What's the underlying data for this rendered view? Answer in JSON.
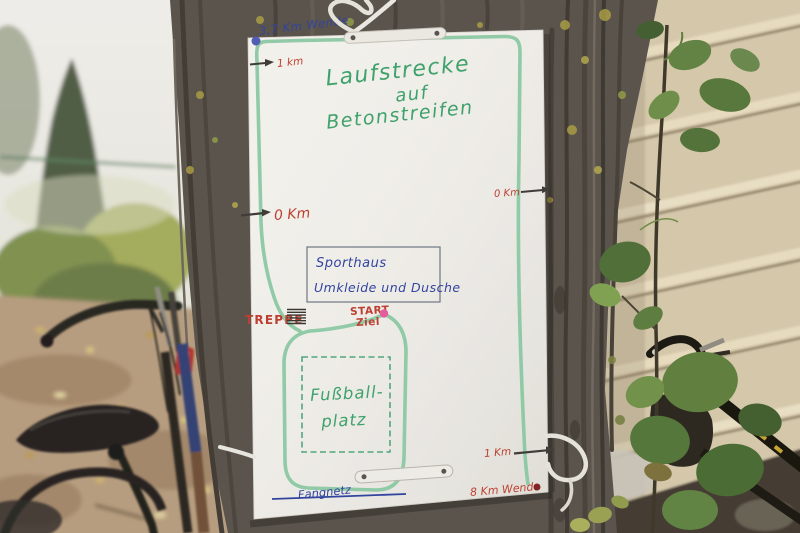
{
  "sign": {
    "title": {
      "line1": "Laufstrecke",
      "line2": "auf",
      "line3": "Betonstreifen"
    },
    "route_labels": {
      "turn_top": "3,7 Km Wende",
      "km1_top_left": "1 km",
      "km0_left": "0 Km",
      "km0_right": "0 Km",
      "km1_bottom_right": "1 Km",
      "turn_bottom": "8 Km Wende"
    },
    "sporthaus": {
      "line1": "Sporthaus",
      "line2": "Umkleide und Dusche"
    },
    "features": {
      "stairs": "TREPPE",
      "start": "START",
      "finish": "Ziel",
      "field_line1": "Fußball-",
      "field_line2": "platz",
      "net": "Fangnetz"
    },
    "colors": {
      "route": "#86c7a1",
      "title_green": "#3aa069",
      "field_green": "#4da67a",
      "ink_blue": "#2c3f9e",
      "ink_red": "#bd3a2c",
      "start_dot": "#e55a9d",
      "turn_dot_top": "#4d58b5",
      "turn_dot_bottom": "#7e2020",
      "paper": "#f4f2ee"
    }
  }
}
